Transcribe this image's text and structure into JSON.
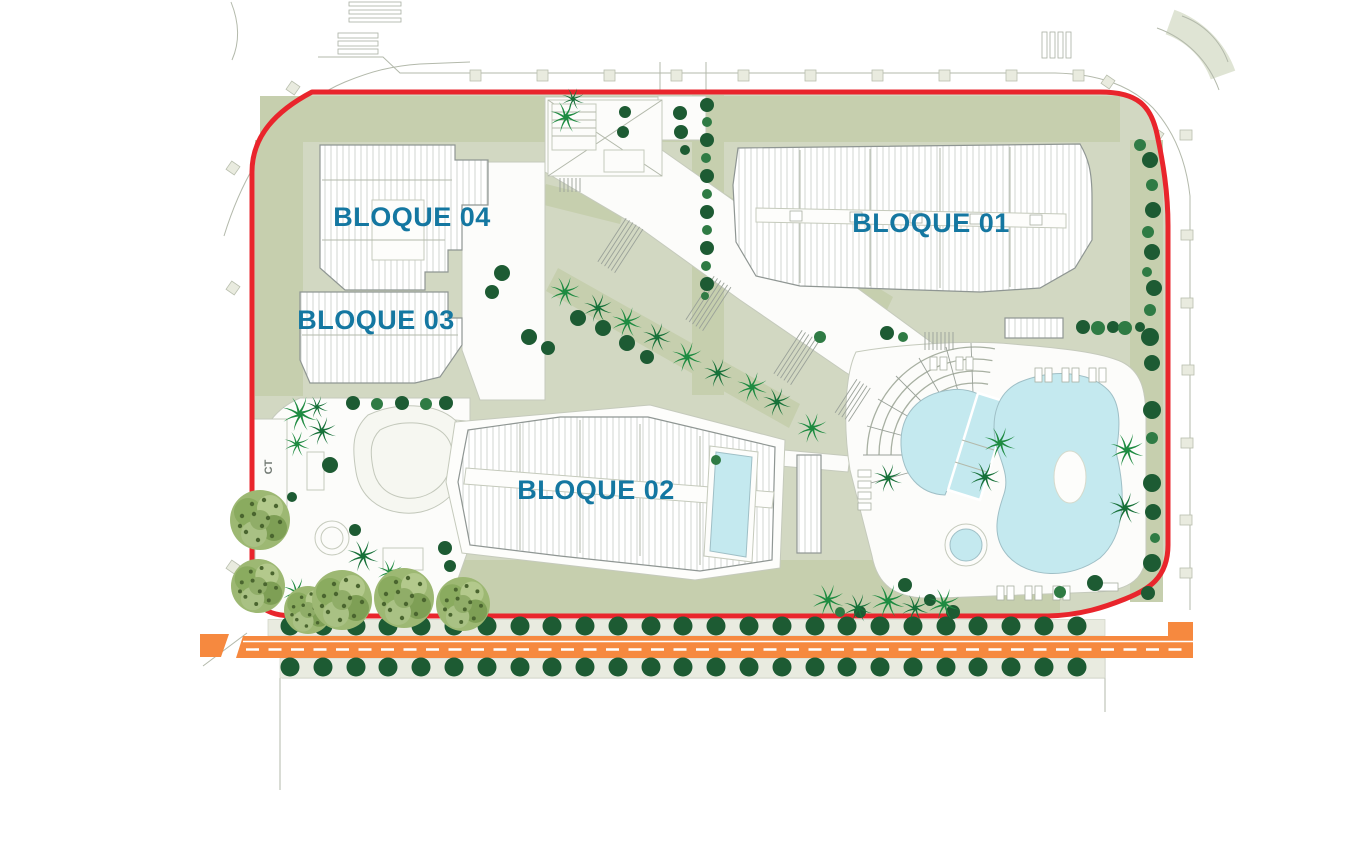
{
  "plan": {
    "blocks": [
      {
        "id": "bloque-01",
        "label": "BLOQUE 01"
      },
      {
        "id": "bloque-02",
        "label": "BLOQUE 02"
      },
      {
        "id": "bloque-03",
        "label": "BLOQUE 03"
      },
      {
        "id": "bloque-04",
        "label": "BLOQUE 04"
      }
    ],
    "annotations": {
      "transformer_cabin": "CT"
    }
  },
  "colors": {
    "boundary_red": "#e9252c",
    "label_teal": "#1477a1",
    "road_orange": "#f6893f",
    "pool_blue": "#c4e9ef",
    "garden_sage": "#d2d8c2",
    "garden_sage_dark": "#c6cfae",
    "tree_dark_green": "#1d5b33",
    "palm_green": "#1e8b41",
    "paving_white": "#fcfcfa",
    "outline_gray": "#8f9693"
  }
}
